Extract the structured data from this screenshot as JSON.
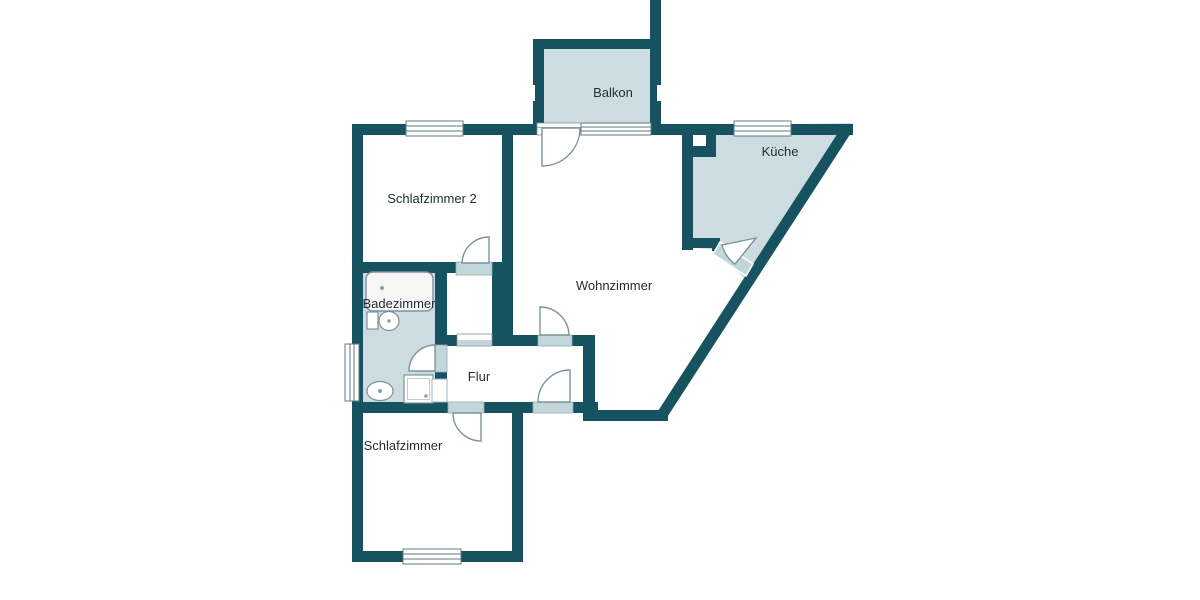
{
  "plan": {
    "type": "apartment-floorplan",
    "rooms": {
      "balkon": {
        "label": "Balkon",
        "shaded": true
      },
      "kueche": {
        "label": "Küche",
        "shaded": true
      },
      "schlafzimmer2": {
        "label": "Schlafzimmer 2",
        "shaded": false
      },
      "wohnzimmer": {
        "label": "Wohnzimmer",
        "shaded": false
      },
      "badezimmer": {
        "label": "Badezimmer",
        "shaded": true
      },
      "flur": {
        "label": "Flur",
        "shaded": false
      },
      "schlafzimmer": {
        "label": "Schlafzimmer",
        "shaded": false
      }
    },
    "fixtures": [
      {
        "name": "bathtub-icon"
      },
      {
        "name": "sink-icon"
      },
      {
        "name": "toilet-icon"
      },
      {
        "name": "shower-icon"
      },
      {
        "name": "washer-icon"
      }
    ],
    "colors": {
      "wall": "#16525f",
      "room_shade": "#ccdce0",
      "threshold": "#c3d6da",
      "outline": "#7d939b",
      "text": "#1f2d33",
      "background": "#ffffff"
    }
  }
}
